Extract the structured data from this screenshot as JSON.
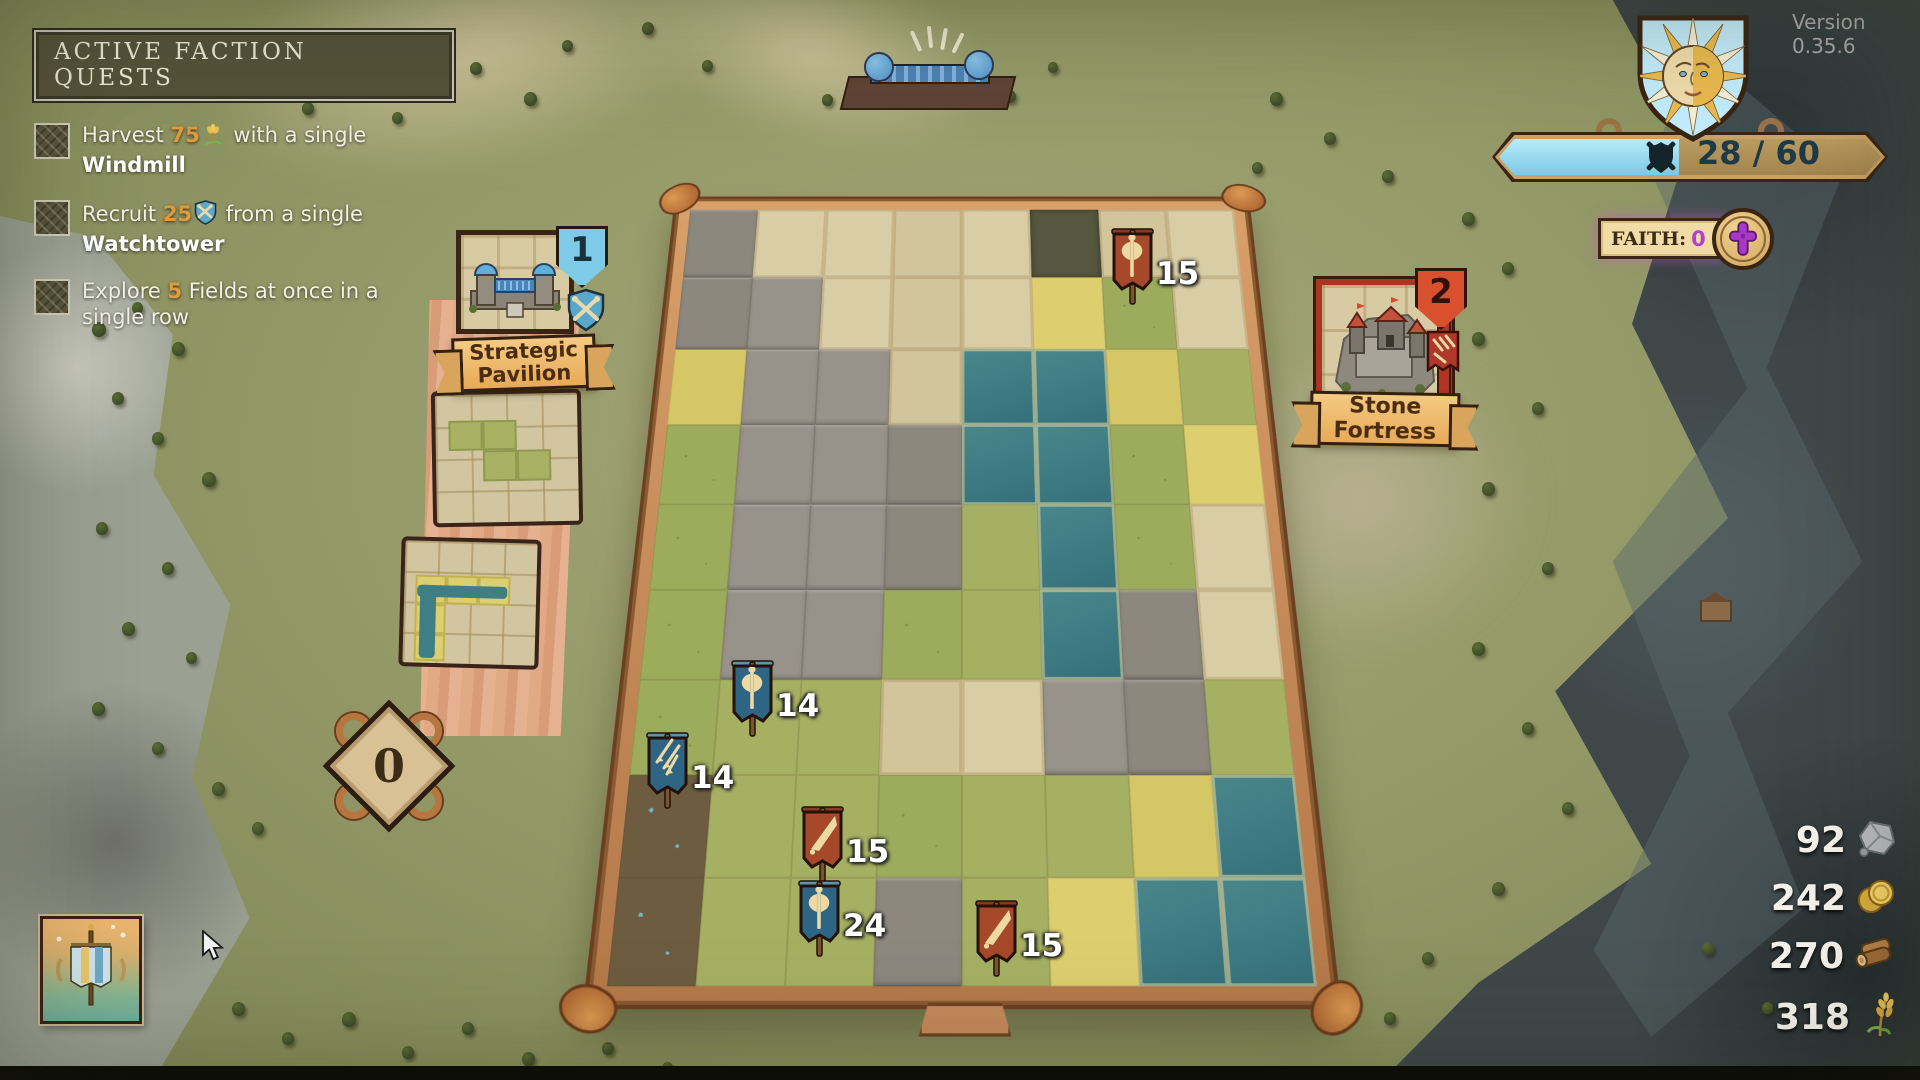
{
  "version_label": "Version 0.35.6",
  "quests_panel": {
    "title": "ACTIVE FACTION QUESTS",
    "quests": [
      {
        "prefix": "Harvest ",
        "amount": "75",
        "icon": "wheat-icon",
        "middle": " with a single ",
        "target": "Windmill"
      },
      {
        "prefix": "Recruit ",
        "amount": "25",
        "icon": "recruit-shield-icon",
        "middle": " from a single ",
        "target": "Watchtower"
      },
      {
        "prefix": "Explore ",
        "amount": "5",
        "icon": "",
        "middle": " Fields at once in a single row",
        "target": ""
      }
    ]
  },
  "war_meter": {
    "current": 28,
    "max": 60,
    "label": "28 / 60",
    "fill_percent": 47,
    "fill_color": "#8ed7f0",
    "icon": "shield-crossed-swords-icon"
  },
  "faith": {
    "label": "FAITH:",
    "value": "0",
    "value_color": "#b43fc9",
    "icon": "cross-icon"
  },
  "build_cards": [
    {
      "name": "Strategic Pavilion",
      "badge": "1",
      "badge_color": "#7ec8e3",
      "emblem": "blue-shield-clubs-icon"
    },
    {
      "name": "Stone Fortress",
      "badge": "2",
      "badge_color": "#d8502e",
      "emblem": "red-pennant-arrows-icon"
    }
  ],
  "tile_queue_count": "0",
  "resources": [
    {
      "name": "stone",
      "value": "92",
      "icon": "stone-icon"
    },
    {
      "name": "gold",
      "value": "242",
      "icon": "gold-coins-icon"
    },
    {
      "name": "wood",
      "value": "270",
      "icon": "wood-log-icon"
    },
    {
      "name": "wheat",
      "value": "318",
      "icon": "wheat-icon"
    }
  ],
  "units": [
    {
      "emblem": "axe",
      "color": "red",
      "count": 15,
      "x": 1106,
      "y": 220
    },
    {
      "emblem": "axe",
      "color": "blue",
      "count": 14,
      "x": 726,
      "y": 652
    },
    {
      "emblem": "arrows",
      "color": "blue",
      "count": 14,
      "x": 641,
      "y": 724
    },
    {
      "emblem": "sword",
      "color": "red",
      "count": 15,
      "x": 796,
      "y": 798
    },
    {
      "emblem": "axe",
      "color": "blue",
      "count": 24,
      "x": 793,
      "y": 872
    },
    {
      "emblem": "sword",
      "color": "red",
      "count": 15,
      "x": 970,
      "y": 892
    }
  ],
  "board": {
    "cols": 8,
    "rows": 9,
    "legend": {
      "u": "unexplored",
      "g": "grass",
      "y": "field",
      "w": "water",
      "m": "mountain",
      "r": "rocky-forest",
      "d": "camp"
    },
    "tiles": [
      "muuuuruu",
      "mmuuuygu",
      "ymmuwwyg",
      "gmmmwwgy",
      "gmmmgwgu",
      "gmmggwmu",
      "ggguummg",
      "dgggggyw",
      "dggmgyww"
    ]
  },
  "icons": {
    "wheat-icon": "golden wheat sprig",
    "recruit-shield-icon": "blue shield with crossed clubs",
    "shield-crossed-swords-icon": "dark shield over crossed swords",
    "cross-icon": "purple flared cross medallion",
    "sun-emblem": "shield with sun face and rays",
    "stone-icon": "gray rock",
    "gold-coins-icon": "two gold coins",
    "wood-log-icon": "wooden log",
    "blue-shield-clubs-icon": "blue shield, crossed cream clubs",
    "red-pennant-arrows-icon": "red pennant with three arrows",
    "axe-banner-icon": "double-bit axe pennant",
    "sword-banner-icon": "sword pennant",
    "arrows-banner-icon": "three arrows pennant",
    "faction-banner-icon": "striped standard on pole",
    "cursor-icon": "mouse pointer"
  }
}
